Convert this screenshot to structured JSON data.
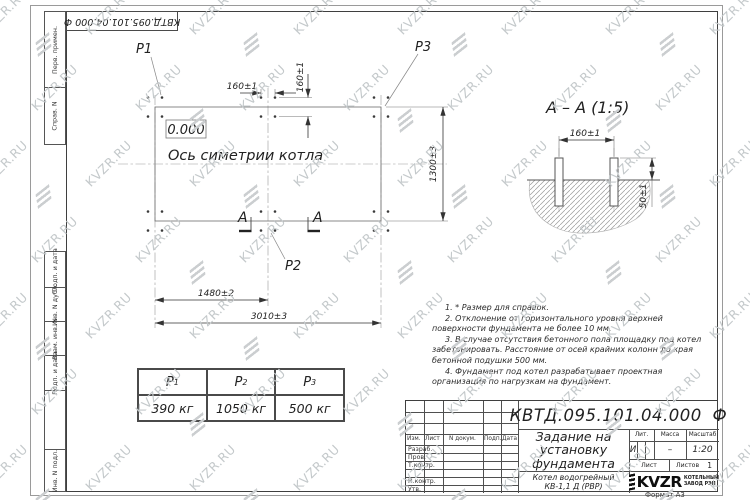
{
  "watermark": {
    "text": "KVZR.RU"
  },
  "stamp_top": {
    "doc_number": "КВТД.095.101.04.000 Ф"
  },
  "frame_labels": {
    "col1": "Перв. примен.",
    "col2": "Справ. N",
    "col3": "Подп. и дата",
    "col4": "Инв. N дубл.",
    "col5": "Взам. инв. N",
    "col6": "Подп. и дата",
    "col7": "Инв. N подл."
  },
  "plan": {
    "p1": "P1",
    "p2": "P2",
    "p3": "P3",
    "elevation": "0.000",
    "axis_label": "Ось симетрии котла",
    "section_letter_left": "А",
    "section_letter_right": "А",
    "dim_bolt_h": "160±1",
    "dim_bolt_v": "160±1",
    "dim_width": "1300±3",
    "dim_span1": "1480±2",
    "dim_span2": "3010±3"
  },
  "section": {
    "title": "А – А (1:5)",
    "dim_spacing": "160±1",
    "dim_height": "50±1"
  },
  "load_table": {
    "headers": [
      {
        "base": "P",
        "sub": "1"
      },
      {
        "base": "P",
        "sub": "2"
      },
      {
        "base": "P",
        "sub": "3"
      }
    ],
    "values": [
      "390 кг",
      "1050 кг",
      "500 кг"
    ]
  },
  "notes": [
    "1. * Размер для справок.",
    "2. Отклонение от горизонтального уровня верхней поверхности фундамента не более 10 мм.",
    "3. В случае отсутствия бетонного пола площадку под котел забетонировать. Расстояние от осей крайних колонн до края бетонной подушки 500 мм.",
    "4. Фундамент под котел разрабатывает проектная организация по нагрузкам на фундамент."
  ],
  "title_block": {
    "doc_number": "КВТД.095.101.04.000 Ф",
    "title_line1": "Задание на",
    "title_line2": "установку",
    "title_line3": "фундамента",
    "product_line1": "Котел водогрейный",
    "product_line2": "КВ-1,1 Д (РВР)",
    "col_izm": "Изм.",
    "col_list": "Лист",
    "col_doc": "N докум.",
    "col_sign": "Подп.",
    "col_date": "Дата",
    "row_razrab": "Разраб.",
    "row_prov": "Пров.",
    "row_tkontr": "Т.контр.",
    "row_nkontr": "Н.контр.",
    "row_utv": "Утв.",
    "lit_header": "Лит.",
    "mass_header": "Масса",
    "scale_header": "Масштаб",
    "lit_value": "И",
    "mass_value": "–",
    "scale_value": "1:20",
    "sheet_label": "Лист",
    "sheets_label": "Листов",
    "sheets_value": "1",
    "logo_text": "KVZR",
    "logo_caption1": "КОТЕЛЬНЫЙ",
    "logo_caption2": "ЗАВОД РЭП",
    "format": "Формат А3"
  }
}
